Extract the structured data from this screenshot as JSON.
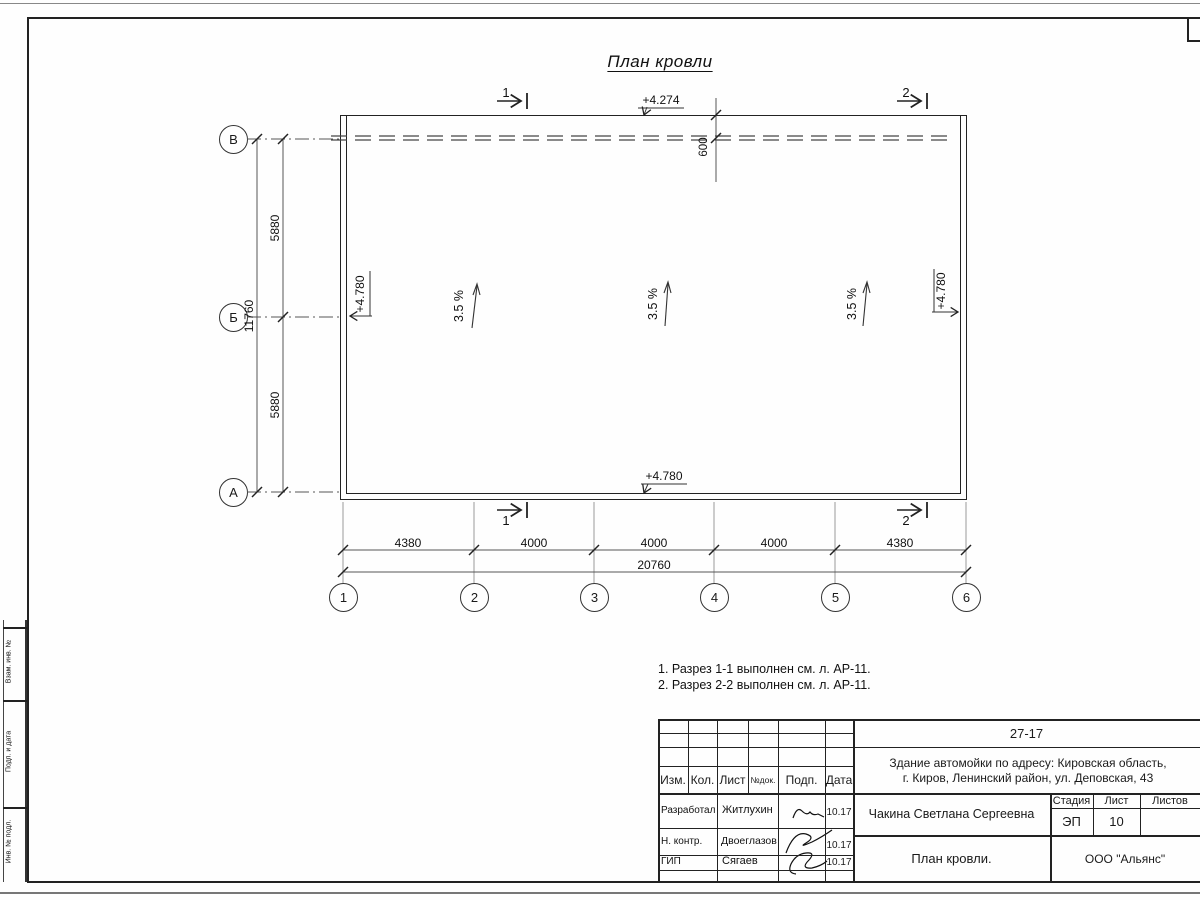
{
  "page": {
    "title_label": "План кровли"
  },
  "plan": {
    "elevations": {
      "top": "+4.274",
      "bottom": "+4.780",
      "left": "+4.780",
      "right": "+4.780"
    },
    "slopes": [
      "3.5 %",
      "3.5 %",
      "3.5 %"
    ],
    "parapet_dim": "600",
    "section_top": [
      "1",
      "2"
    ],
    "section_bottom": [
      "1",
      "2"
    ],
    "row_axes": [
      "В",
      "Б",
      "А"
    ],
    "col_axes": [
      "1",
      "2",
      "3",
      "4",
      "5",
      "6"
    ],
    "v_dims": {
      "segments": [
        "5880",
        "5880"
      ],
      "total": "11760"
    },
    "h_dims": {
      "segments": [
        "4380",
        "4000",
        "4000",
        "4000",
        "4380"
      ],
      "total": "20760"
    }
  },
  "notes": [
    "1. Разрез 1-1 выполнен см. л. АР-11.",
    "2. Разрез 2-2 выполнен см. л. АР-11."
  ],
  "titleblock": {
    "doc_number": "27-17",
    "project_line1": "Здание автомойки по адресу: Кировская область,",
    "project_line2": "г. Киров, Ленинский район, ул. Деповская, 43",
    "header_cols": [
      "Изм.",
      "Кол.",
      "Лист",
      "№док.",
      "Подп.",
      "Дата"
    ],
    "personnel": [
      {
        "role": "Разработал",
        "name": "Житлухин",
        "date": "10.17"
      },
      {
        "role": "Н. контр.",
        "name": "Двоеглазов",
        "date": "10.17"
      },
      {
        "role": "ГИП",
        "name": "Сягаев",
        "date": "10.17"
      }
    ],
    "client": "Чакина Светлана Сергеевна",
    "stage_label": "Стадия",
    "sheet_label": "Лист",
    "sheets_label": "Листов",
    "stage": "ЭП",
    "sheet_number": "10",
    "sheet_title": "План кровли.",
    "organization": "ООО \"Альянс\""
  },
  "frame": {
    "side_labels": [
      "Взам. инв. №",
      "Подп. и дата",
      "Инв. № подл."
    ]
  }
}
